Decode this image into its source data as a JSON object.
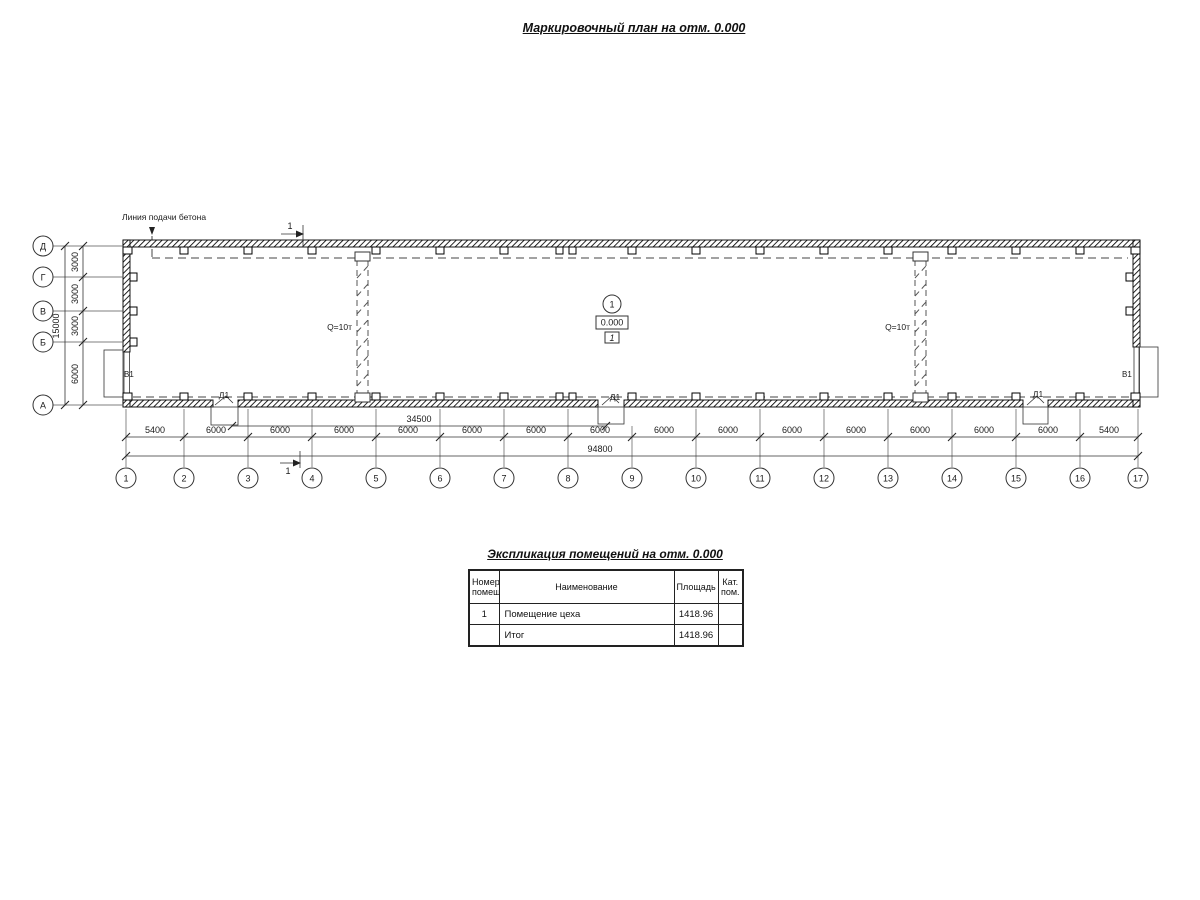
{
  "page": {
    "title": "Маркировочный план на отм. 0.000"
  },
  "plan": {
    "concrete_line_label": "Линия подачи бетона",
    "section_mark": "1",
    "crane_labels": [
      "Q=10т",
      "Q=10т"
    ],
    "gate_labels": [
      "В1",
      "В1"
    ],
    "door_labels": [
      "Д1",
      "Д1",
      "Д1"
    ],
    "room_marker": {
      "axis": "1",
      "elevation": "0.000",
      "room": "1"
    },
    "axes_bottom": [
      "1",
      "2",
      "3",
      "4",
      "5",
      "6",
      "7",
      "8",
      "9",
      "10",
      "11",
      "12",
      "13",
      "14",
      "15",
      "16",
      "17"
    ],
    "axes_left": [
      "Д",
      "Г",
      "В",
      "Б",
      "А"
    ],
    "bay_dims": [
      "5400",
      "6000",
      "6000",
      "6000",
      "6000",
      "6000",
      "6000",
      "6000",
      "6000",
      "6000",
      "6000",
      "6000",
      "6000",
      "6000",
      "6000",
      "5400"
    ],
    "dim_span": "34500",
    "dim_total_bottom": "94800",
    "left_dims": [
      "3000",
      "3000",
      "3000",
      "6000"
    ],
    "dim_total_left": "15000"
  },
  "schedule": {
    "title": "Экспликация помещений на отм. 0.000",
    "columns": [
      "Номер помещ.",
      "Наименование",
      "Площадь",
      "Кат. пом."
    ],
    "rows": [
      {
        "number": "1",
        "name": "Помещение цеха",
        "area": "1418.96",
        "category": ""
      },
      {
        "number": "",
        "name": "Итог",
        "area": "1418.96",
        "category": ""
      }
    ]
  }
}
